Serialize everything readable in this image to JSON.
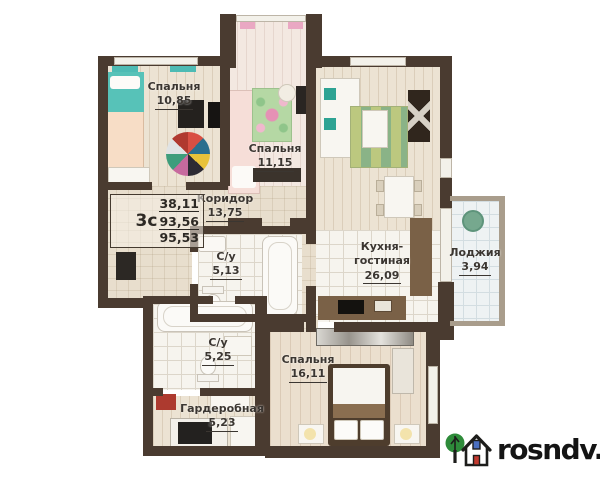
{
  "rooms": {
    "bedroom1": {
      "name": "Спальня",
      "area": "10,85"
    },
    "bedroom2": {
      "name": "Спальня",
      "area": "11,15"
    },
    "kitchen_living": {
      "name": "Кухня-гостиная",
      "area": "26,09"
    },
    "loggia": {
      "name": "Лоджия",
      "area": "3,94"
    },
    "corridor": {
      "name": "Коридор",
      "area": "13,75"
    },
    "bathroom1": {
      "name": "С/у",
      "area": "5,13"
    },
    "bathroom2": {
      "name": "С/у",
      "area": "5,25"
    },
    "wardrobe": {
      "name": "Гардеробная",
      "area": "5,23"
    },
    "bedroom3": {
      "name": "Спальня",
      "area": "16,11"
    }
  },
  "spec": {
    "type": "3с",
    "line1": "38,11",
    "line2": "93,56",
    "line3": "95,53"
  },
  "watermark": {
    "text": "rosndv.ru",
    "icon": "house-with-tree-icon"
  },
  "colors": {
    "wall": "#4a3b30",
    "bed_teal": "#57c2b8",
    "bed_pink": "#f6ded8",
    "rug_green": "#bcc87f",
    "logo_tree": "#2e8b3a",
    "logo_door": "#c23a30",
    "logo_window": "#4a6fc0"
  }
}
